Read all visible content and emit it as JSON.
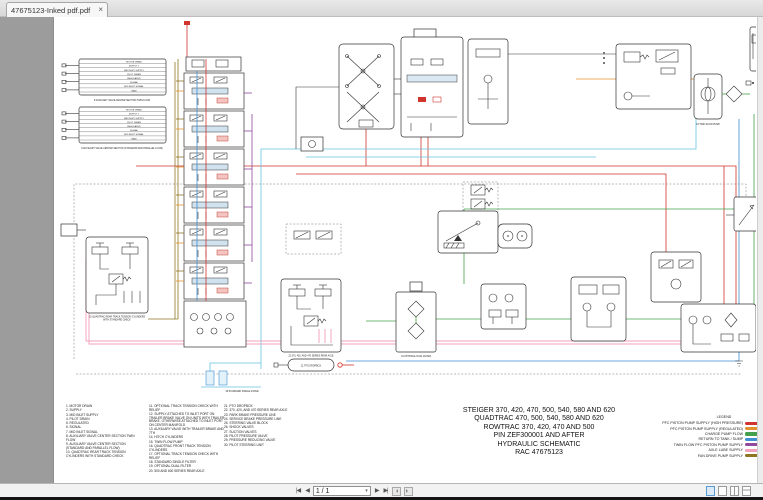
{
  "window": {
    "tab_title": "47675123-Inked pdf.pdf",
    "tab_close": "×"
  },
  "toolbar": {
    "page_field": "1 / 1",
    "dropdown_glyph": "▾",
    "first_label": "|◀",
    "prev_label": "◀",
    "next_label": "▶",
    "last_label": "▶|"
  },
  "page": {
    "title_block": {
      "lines": [
        "STEIGER 370, 420, 470, 500, 540, 580 AND 620",
        "QUADTRAC 470, 500, 540, 580 AND 620",
        "ROWTRAC 370, 420, 470 AND 500",
        "PIN ZEF300001 AND AFTER",
        "HYDRAULIC SCHEMATIC",
        "RAC 47675123"
      ]
    },
    "legend": {
      "title": "LEGEND",
      "entries": [
        {
          "label": "PFC PISTON PUMP SUPPLY (HIGH PRESSURE)",
          "color": "#d0342c"
        },
        {
          "label": "PFC PISTON PUMP SUPPLY (REGULATED)",
          "color": "#e2902f"
        },
        {
          "label": "CHARGE PUMP FLOW",
          "color": "#44a04c"
        },
        {
          "label": "RETURN TO TANK / SUMP",
          "color": "#3f8fd2"
        },
        {
          "label": "TWIN FLOW PFC PISTON PUMP SUPPLY",
          "color": "#8f4a9e"
        },
        {
          "label": "AXLE LUBE SUPPLY",
          "color": "#f2a0bb"
        },
        {
          "label": "FAN DRIVE PUMP SUPPLY",
          "color": "#8f7422"
        }
      ]
    },
    "parts_list": {
      "col1": [
        "1. MOTOR DRAIN",
        "2. SUPPLY",
        "3. MID INLET SUPPLY",
        "4. PILOT DRAIN",
        "5. REGULATED",
        "6. SIGNAL",
        "7. MID INLET SIGNAL",
        "8. AUXILIARY VALVE CENTER SECTION TWIN FLOW",
        "9. AUXILIARY VALVE CENTER SECTION (STANDARD AND PARALLEL FLOW)",
        "10. QUADTRAC REAR TRACK TENSION CYLINDERS WITH STANDARD CHECK"
      ],
      "col2": [
        "11. OPTIONAL TRACK TENSION CHECK WITH RELIEF",
        "12. SUPPLY ATTACHED TO INLET PORT ON TRAILER BRAKE VALVE ON UNITS WITH TRAILER BRAKE, OTHERWISE ATTACHED TO INLET PORT ON CENTER MANIFOLD",
        "13. AUXILIARY VALVE WITH TRAILER BRAKE AND 7TH",
        "14. HITCH CYLINDERS",
        "15. TWIN FLOW PUMP",
        "16. QUADTRAC FRONT TRACK TENSION CYLINDERS",
        "17. OPTIONAL TRACK TENSION CHECK WITH RELIEF",
        "18. STANDARD SINGLE FILTER",
        "19. OPTIONAL DUAL FILTER",
        "20. 500 AND 600 SERIES REAR AXLE"
      ],
      "col3": [
        "21. PTO DROPBOX",
        "22. 370, 420, AND 470 SERIES REAR AXLE",
        "23. PARK BRAKE PRESSURE LINE",
        "24. SERVICE BRAKE PRESSURE LINE",
        "25. STEERING VALVE BLOCK",
        "26. SHOCK VALVES",
        "27. SUCTION VALVES",
        "28. PILOT PRESSURE VALVE",
        "29. PRESSURE REDUCING VALVE",
        "30. PILOT STEERING UNIT"
      ]
    },
    "valve_blocks": {
      "rows": [
        "MOTOR DRAIN",
        "SUPPLY 1",
        "MID INLET SUPPLY",
        "PILOT DRAIN",
        "REGULATED",
        "SIGNAL",
        "MID INLET SIGNAL",
        "RAW"
      ],
      "caption_a": "8  AUXILIARY VALVE CENTER SECTION TWIN FLOW",
      "caption_b": "9  AUXILIARY VALVE CENTER SECTION (STANDARD AND PARALLEL FLOW)"
    },
    "captions": {
      "track_line1": "10  QUADTRAC REAR TRACK TENSION CYLINDERS",
      "track_line2": "WITH STANDARD CHECK",
      "rear_axle": "22  370, 420, AND 470 SERIES REAR AXLE",
      "pto": "21  PTO DROPBOX",
      "dual_filter": "19  OPTIONAL DUAL FILTER",
      "single_filter": "18  STANDARD SINGLE FILTER",
      "twin_pump": "15  TWIN FLOW PUMP"
    }
  }
}
